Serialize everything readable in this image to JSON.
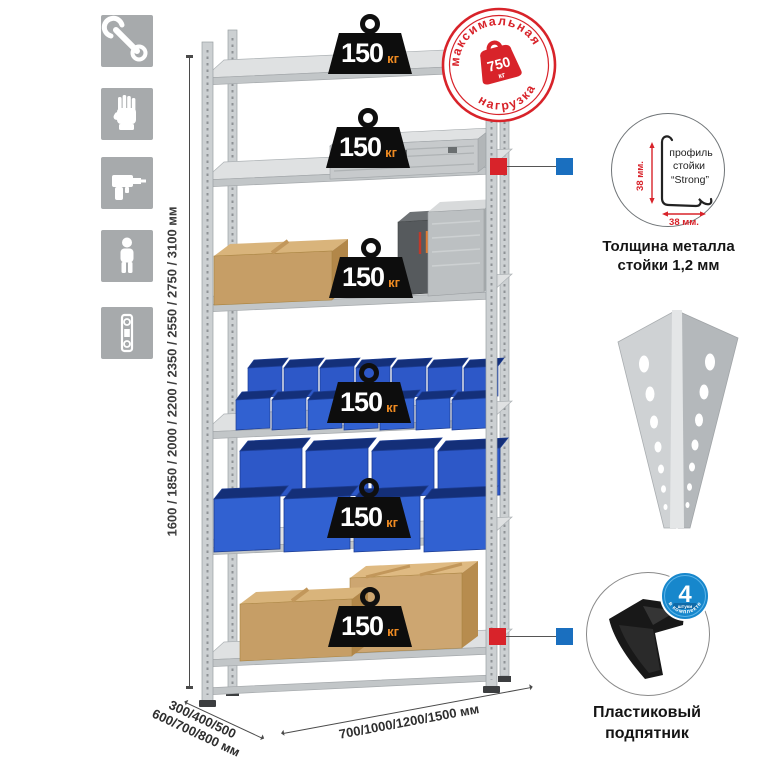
{
  "sidebar": {
    "icons": [
      "wrench",
      "gloves",
      "drill",
      "person",
      "level"
    ]
  },
  "dimensions": {
    "height_label": "1600 / 1850 / 2000 / 2200 / 2350 / 2550 / 2750 / 3100 мм",
    "depth_line1": "300/400/500",
    "depth_line2": "600/700/800 мм",
    "width_label": "700/1000/1200/1500 мм"
  },
  "rack": {
    "shelf_loads": [
      "150",
      "150",
      "150",
      "150",
      "150",
      "150"
    ],
    "load_unit": "кг"
  },
  "max_load_stamp": {
    "arc_top": "максимальная",
    "arc_bottom": "нагрузка",
    "value": "750",
    "unit": "кг"
  },
  "profile_detail": {
    "label_line1": "профиль",
    "label_line2": "стойки",
    "label_line3": "“Strong”",
    "vertical_dim": "38 мм.",
    "horizontal_dim": "38 мм.",
    "caption_line1": "Толщина металла",
    "caption_line2": "стойки 1,2 мм"
  },
  "foot_detail": {
    "badge_value": "4",
    "badge_word": "штуки",
    "badge_arc": "в комплекте",
    "caption_line1": "Пластиковый",
    "caption_line2": "подпятник"
  },
  "colors": {
    "stamp_red": "#d8232a",
    "badge_blue": "#1787cc",
    "bin_blue": "#2d58c8",
    "metal_gray": "#cfd2d4",
    "icon_gray": "#a7aaac"
  }
}
